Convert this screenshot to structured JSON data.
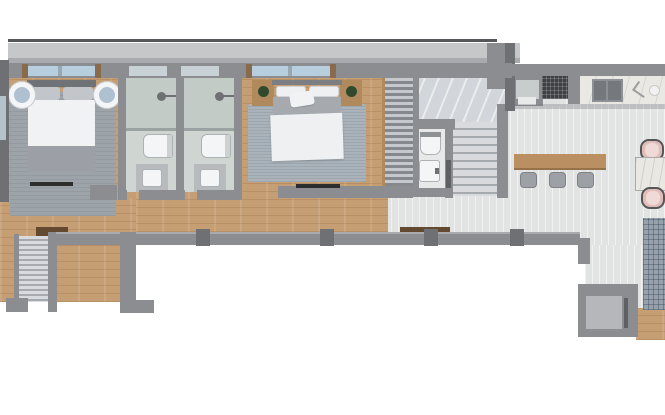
{
  "scene": {
    "type": "floor-plan",
    "description": "Top-down 3D rendered floor plan of a long single-storey apartment",
    "width_px": 665,
    "height_px": 415
  },
  "rooms": {
    "bedroom1": "Bedroom 1",
    "bathroom1": "Bathroom 1",
    "bathroom2": "Bathroom 2",
    "bedroom2": "Bedroom 2",
    "wardrobe": "Wardrobe",
    "wc": "Guest WC",
    "staircase": "Staircase",
    "hallway": "Hallway",
    "entrance_stairs": "Entrance stairs",
    "kitchen": "Kitchen",
    "dining": "Dining area",
    "living": "Living area",
    "entry": "Entry vestibule"
  },
  "furniture": {
    "bed1": "Double bed with gray blanket",
    "bed2": "Double bed with white duvet",
    "nightstand_round": "Round white nightstand",
    "nightstand_wood": "Wooden nightstand with plant",
    "toilet": "Toilet",
    "vanity": "Vanity with sink",
    "shower": "Walk-in shower",
    "tv": "Wall-mounted TV",
    "breakfast_bar": "Wooden breakfast bar with stools",
    "dining_table": "Marble dining table with two chairs",
    "kitchen_counter": "Kitchen counter with hob and sink",
    "rug": "Area rug"
  },
  "palette": {
    "wall": "#8b8d91",
    "wallDark": "#6e7074",
    "wallLight": "#a8aaad",
    "parapet": "#c6c7c9",
    "topLine": "#55575a",
    "wood": "#c69e74",
    "tile": "#e2e4e3",
    "bathTile": "#cfd6d2",
    "showerTile": "#c3cbc7",
    "glassLine": "#9aa3a1",
    "marble": "#d2d5d9",
    "stairLight": "#d8dadd",
    "stairDark": "#a6aaae",
    "rugGray": "#9da4a9",
    "rugBlue": "#aab3ba",
    "rugGrid": "#96a1ac",
    "bedSheet": "#f1f2f3",
    "bedBlanket": "#9c9fa5",
    "pillow": "#c2c5ca",
    "headboard": "#6f7277",
    "headboard2": "#7b7e83",
    "duvet": "#eef0f1",
    "bedTop2": "#a6aaaf",
    "woodFurn": "#b0895c",
    "plant": "#30492c",
    "white": "#f4f5f6",
    "vanity": "#b7bbbd",
    "stool": "#9da0a4",
    "barWood": "#ba9062",
    "counter": "#eae8e3",
    "sinkDark": "#75787c",
    "grill": "#3e4144",
    "blush": "#e2bcb7",
    "chairLine": "#54575a",
    "matBrown": "#63492f",
    "tvBlack": "#2b2d2f",
    "winGlass": "#b6cedd",
    "winFrost": "#c8d2d6",
    "winTrim": "#8a6a4c",
    "slatLight": "#c6c9cc",
    "slatDark": "#85898d",
    "doorDark": "#5e6164",
    "entryInner": "#b5b7ba",
    "wcFloor": "#e7e9e8",
    "leftWin": "#b4c2cb"
  }
}
